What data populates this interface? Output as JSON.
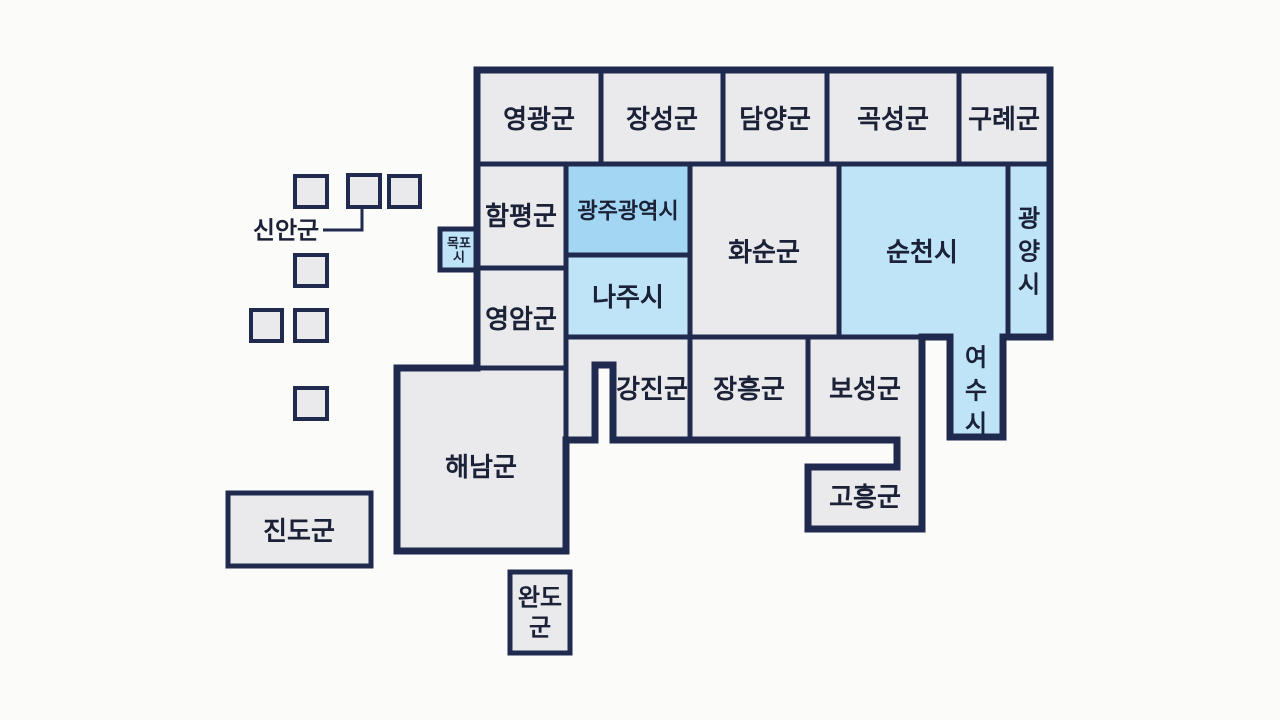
{
  "map": {
    "type": "tile-grid-map",
    "colors": {
      "background": "#fbfbf9",
      "county": "#eaeaec",
      "city": "#bfe4f7",
      "metro": "#a2d6f2",
      "border": "#1f2a4e",
      "text": "#1b2136"
    },
    "regions": [
      {
        "id": "yeonggwang",
        "label": "영광군",
        "fill": "county",
        "path": "M477,70 H601 V164 H477 Z",
        "label_x": 539,
        "label_y": 119,
        "font_size": 26
      },
      {
        "id": "jangseong",
        "label": "장성군",
        "fill": "county",
        "path": "M601,70 H723 V164 H601 Z",
        "label_x": 662,
        "label_y": 119,
        "font_size": 26
      },
      {
        "id": "damyang",
        "label": "담양군",
        "fill": "county",
        "path": "M723,70 H827 V164 H723 Z",
        "label_x": 775,
        "label_y": 119,
        "font_size": 26
      },
      {
        "id": "gokseong",
        "label": "곡성군",
        "fill": "county",
        "path": "M827,70 H959 V164 H827 Z",
        "label_x": 893,
        "label_y": 119,
        "font_size": 26
      },
      {
        "id": "gurye",
        "label": "구례군",
        "fill": "county",
        "path": "M959,70 H1050 V164 H959 Z",
        "label_x": 1004,
        "label_y": 119,
        "font_size": 26
      },
      {
        "id": "hampyeong",
        "label": "함평군",
        "fill": "county",
        "path": "M477,164 H566 V268 H477 Z",
        "label_x": 521,
        "label_y": 216,
        "font_size": 26
      },
      {
        "id": "yeongam",
        "label": "영암군",
        "fill": "county",
        "path": "M477,268 H566 V368 H477 Z",
        "label_x": 521,
        "label_y": 319,
        "font_size": 26
      },
      {
        "id": "gwangju",
        "label": "광주광역시",
        "fill": "metro",
        "path": "M566,164 H690 V255 H566 Z",
        "label_x": 628,
        "label_y": 211,
        "font_size": 22
      },
      {
        "id": "naju",
        "label": "나주시",
        "fill": "city",
        "path": "M566,255 H690 V337 H566 Z",
        "label_x": 628,
        "label_y": 297,
        "font_size": 26
      },
      {
        "id": "hwasun",
        "label": "화순군",
        "fill": "county",
        "path": "M690,164 H839 V337 H690 Z",
        "label_x": 764,
        "label_y": 252,
        "font_size": 26
      },
      {
        "id": "suncheon",
        "label": "순천시",
        "fill": "city",
        "path": "M839,164 H1008 V337 H1003 V437 H950 V337 H839 Z",
        "label_x": 922,
        "label_y": 252,
        "font_size": 26
      },
      {
        "id": "gwangyang",
        "label": "광양시",
        "fill": "city",
        "path": "M1008,164 H1050 V337 H1008 Z",
        "label_x": 1029,
        "label_y": 252,
        "font_size": 24,
        "lines": [
          "광",
          "양",
          "시"
        ],
        "line_height": 33
      },
      {
        "id": "yeosu",
        "label": "여수시",
        "fill": "city",
        "path": null,
        "label_x": 976,
        "label_y": 391,
        "font_size": 24,
        "lines": [
          "여",
          "수",
          "시"
        ],
        "line_height": 33
      },
      {
        "id": "gangjin",
        "label": "강진군",
        "fill": "county",
        "path": "M566,337 H690 V440 H613 V365 H595 V440 H566 Z",
        "label_x": 652,
        "label_y": 389,
        "font_size": 26
      },
      {
        "id": "jangheung",
        "label": "장흥군",
        "fill": "county",
        "path": "M690,337 H808 V440 H690 Z",
        "label_x": 749,
        "label_y": 389,
        "font_size": 26
      },
      {
        "id": "boseong",
        "label": "보성군",
        "fill": "county",
        "path": "M808,337 H922 V529 H808 V467 H897 V440 H808 Z",
        "label_x": 865,
        "label_y": 389,
        "font_size": 26
      },
      {
        "id": "goheung",
        "label": "고흥군",
        "fill": "county",
        "path": null,
        "label_x": 865,
        "label_y": 497,
        "font_size": 26
      },
      {
        "id": "haenam",
        "label": "해남군",
        "fill": "county",
        "path": "M397,368 H566 V551 H397 Z",
        "label_x": 481,
        "label_y": 467,
        "font_size": 26
      },
      {
        "id": "mokpo",
        "label": "목포시",
        "fill": "city",
        "path": "M440,229 H478 V270 H440 Z",
        "label_x": 459,
        "label_y": 250,
        "font_size": 13,
        "lines": [
          "목포",
          "시"
        ],
        "line_height": 14
      },
      {
        "id": "jindo",
        "label": "진도군",
        "fill": "county",
        "path": "M228,493 H371 V566 H228 Z",
        "label_x": 299,
        "label_y": 531,
        "font_size": 26
      },
      {
        "id": "wando",
        "label": "완도군",
        "fill": "county",
        "path": "M510,572 H570 V653 H510 Z",
        "label_x": 540,
        "label_y": 613,
        "font_size": 24,
        "lines": [
          "완도",
          "군"
        ],
        "line_height": 30
      }
    ],
    "sinan": {
      "label": "신안군",
      "label_x": 286,
      "label_y": 231,
      "font_size": 24,
      "leader_path": "M323,230 H362 V208",
      "squares": [
        [
          295,
          176,
          32,
          31
        ],
        [
          348,
          175,
          32,
          32
        ],
        [
          389,
          176,
          31,
          31
        ],
        [
          295,
          255,
          32,
          31
        ],
        [
          251,
          310,
          31,
          31
        ],
        [
          295,
          310,
          32,
          31
        ],
        [
          295,
          388,
          32,
          31
        ]
      ]
    },
    "outline_path": "M477,70 H1050 V337 H1003 V437 H950 V337 H922 V529 H808 V467 H897 V440 H613 V365 H595 V440 H566 V551 H397 V368 H477 Z"
  }
}
